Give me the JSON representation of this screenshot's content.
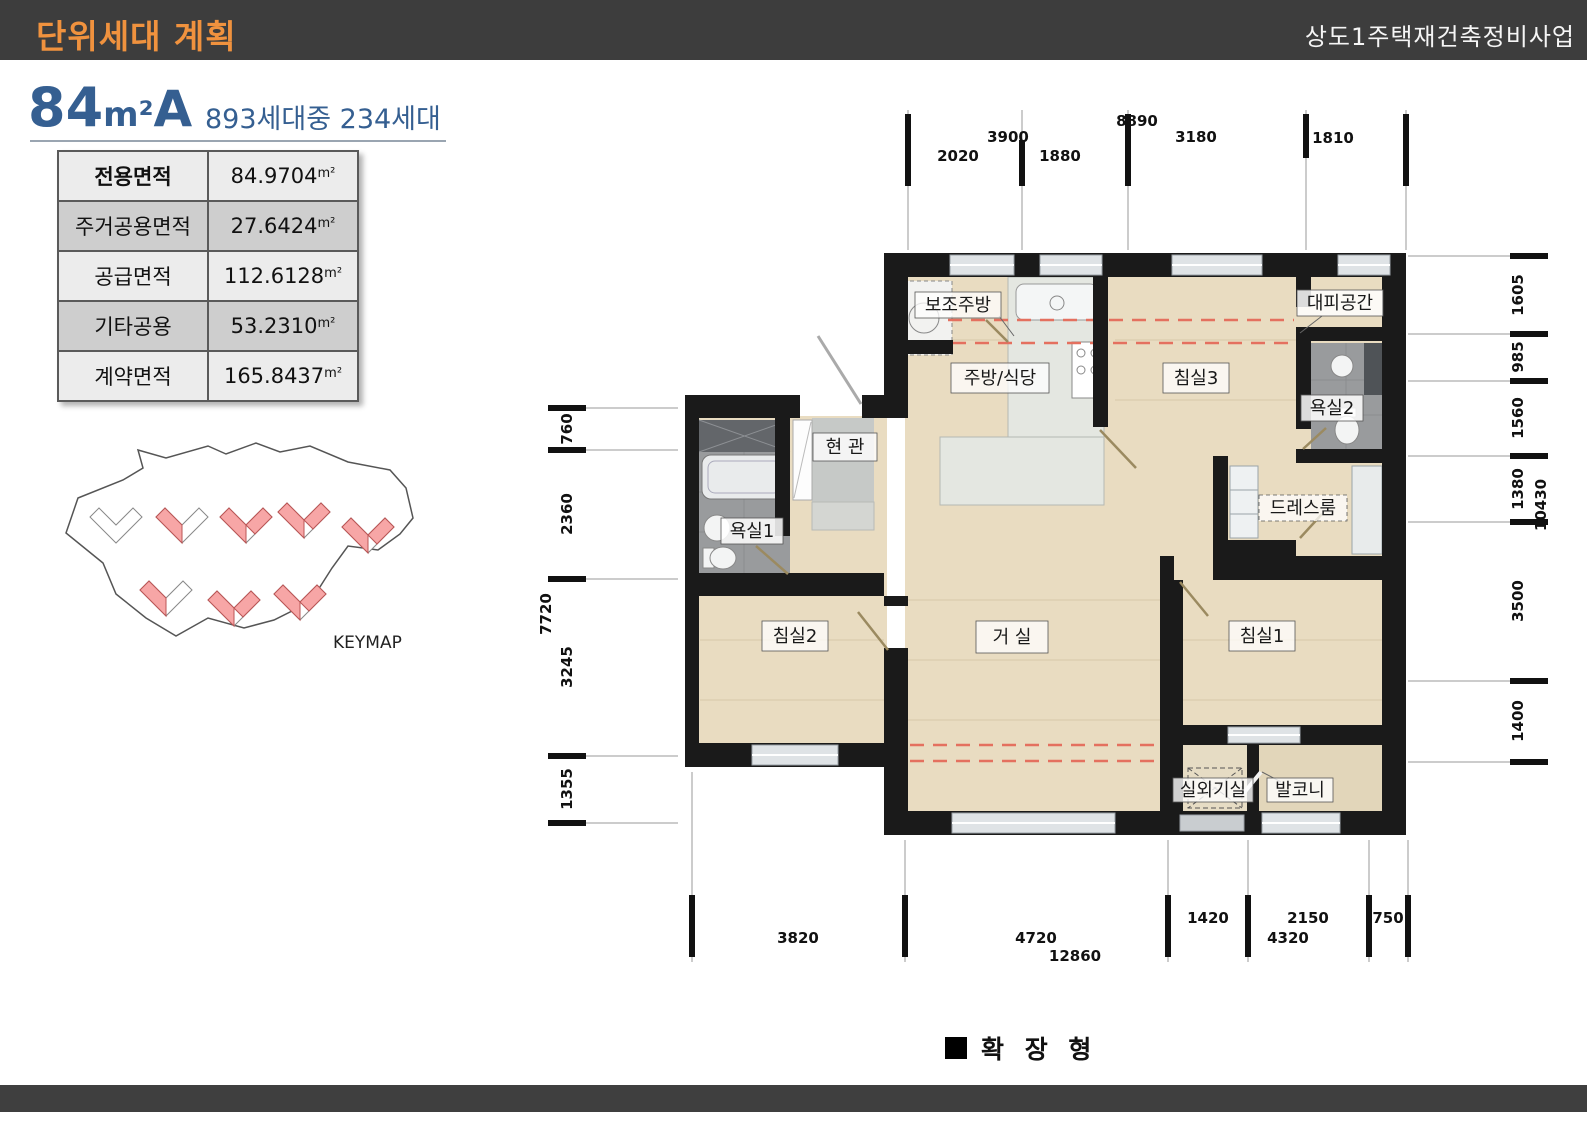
{
  "header": {
    "title": "단위세대 계획",
    "project": "상도1주택재건축정비사업"
  },
  "unit": {
    "size": "84",
    "unit": "m²",
    "type": "A",
    "households": "893세대중 234세대"
  },
  "area_table": {
    "rows": [
      {
        "label": "전용면적",
        "value": "84.9704",
        "unit": "m²"
      },
      {
        "label": "주거공용면적",
        "value": "27.6424",
        "unit": "m²"
      },
      {
        "label": "공급면적",
        "value": "112.6128",
        "unit": "m²"
      },
      {
        "label": "기타공용",
        "value": "53.2310",
        "unit": "m²"
      },
      {
        "label": "계약면적",
        "value": "165.8437",
        "unit": "m²"
      }
    ]
  },
  "keymap": {
    "label": "KEYMAP"
  },
  "plan": {
    "rooms": {
      "aux_kitchen": {
        "label": "보조주방"
      },
      "kitchen": {
        "label": "주방/식당"
      },
      "bedroom3": {
        "label": "침실3"
      },
      "evac": {
        "label": "대피공간"
      },
      "bath2": {
        "label": "욕실2"
      },
      "entrance": {
        "label": "현 관"
      },
      "bath1": {
        "label": "욕실1"
      },
      "dress": {
        "label": "드레스룸"
      },
      "bedroom2": {
        "label": "침실2"
      },
      "living": {
        "label": "거 실"
      },
      "bedroom1": {
        "label": "침실1"
      },
      "outdoor": {
        "label": "실외기실"
      },
      "balcony": {
        "label": "발코니"
      }
    },
    "dims": {
      "top": {
        "total": "8890",
        "sub": "3900",
        "segments": [
          "2020",
          "1880",
          "3180",
          "1810"
        ]
      },
      "bottom": {
        "total": "12860",
        "sub": "4320",
        "segments": [
          "3820",
          "4720",
          "1420",
          "2150",
          "750"
        ]
      },
      "left": {
        "total": "7720",
        "segments": [
          "760",
          "2360",
          "3245",
          "1355"
        ]
      },
      "right": {
        "total": "10430",
        "segments": [
          "1605",
          "985",
          "1560",
          "1380",
          "3500",
          "1400"
        ]
      }
    }
  },
  "legend": {
    "label": "확 장 형"
  },
  "colors": {
    "accent_orange": "#f0923e",
    "accent_blue": "#355f91",
    "bar_dark": "#3d3d3d",
    "floor_beige": "#e9dcc1",
    "wall_black": "#1a1a1a",
    "wet_gray": "#999b9d",
    "highlight_pink": "#f7a6a6",
    "dash_red": "#e4705f"
  }
}
